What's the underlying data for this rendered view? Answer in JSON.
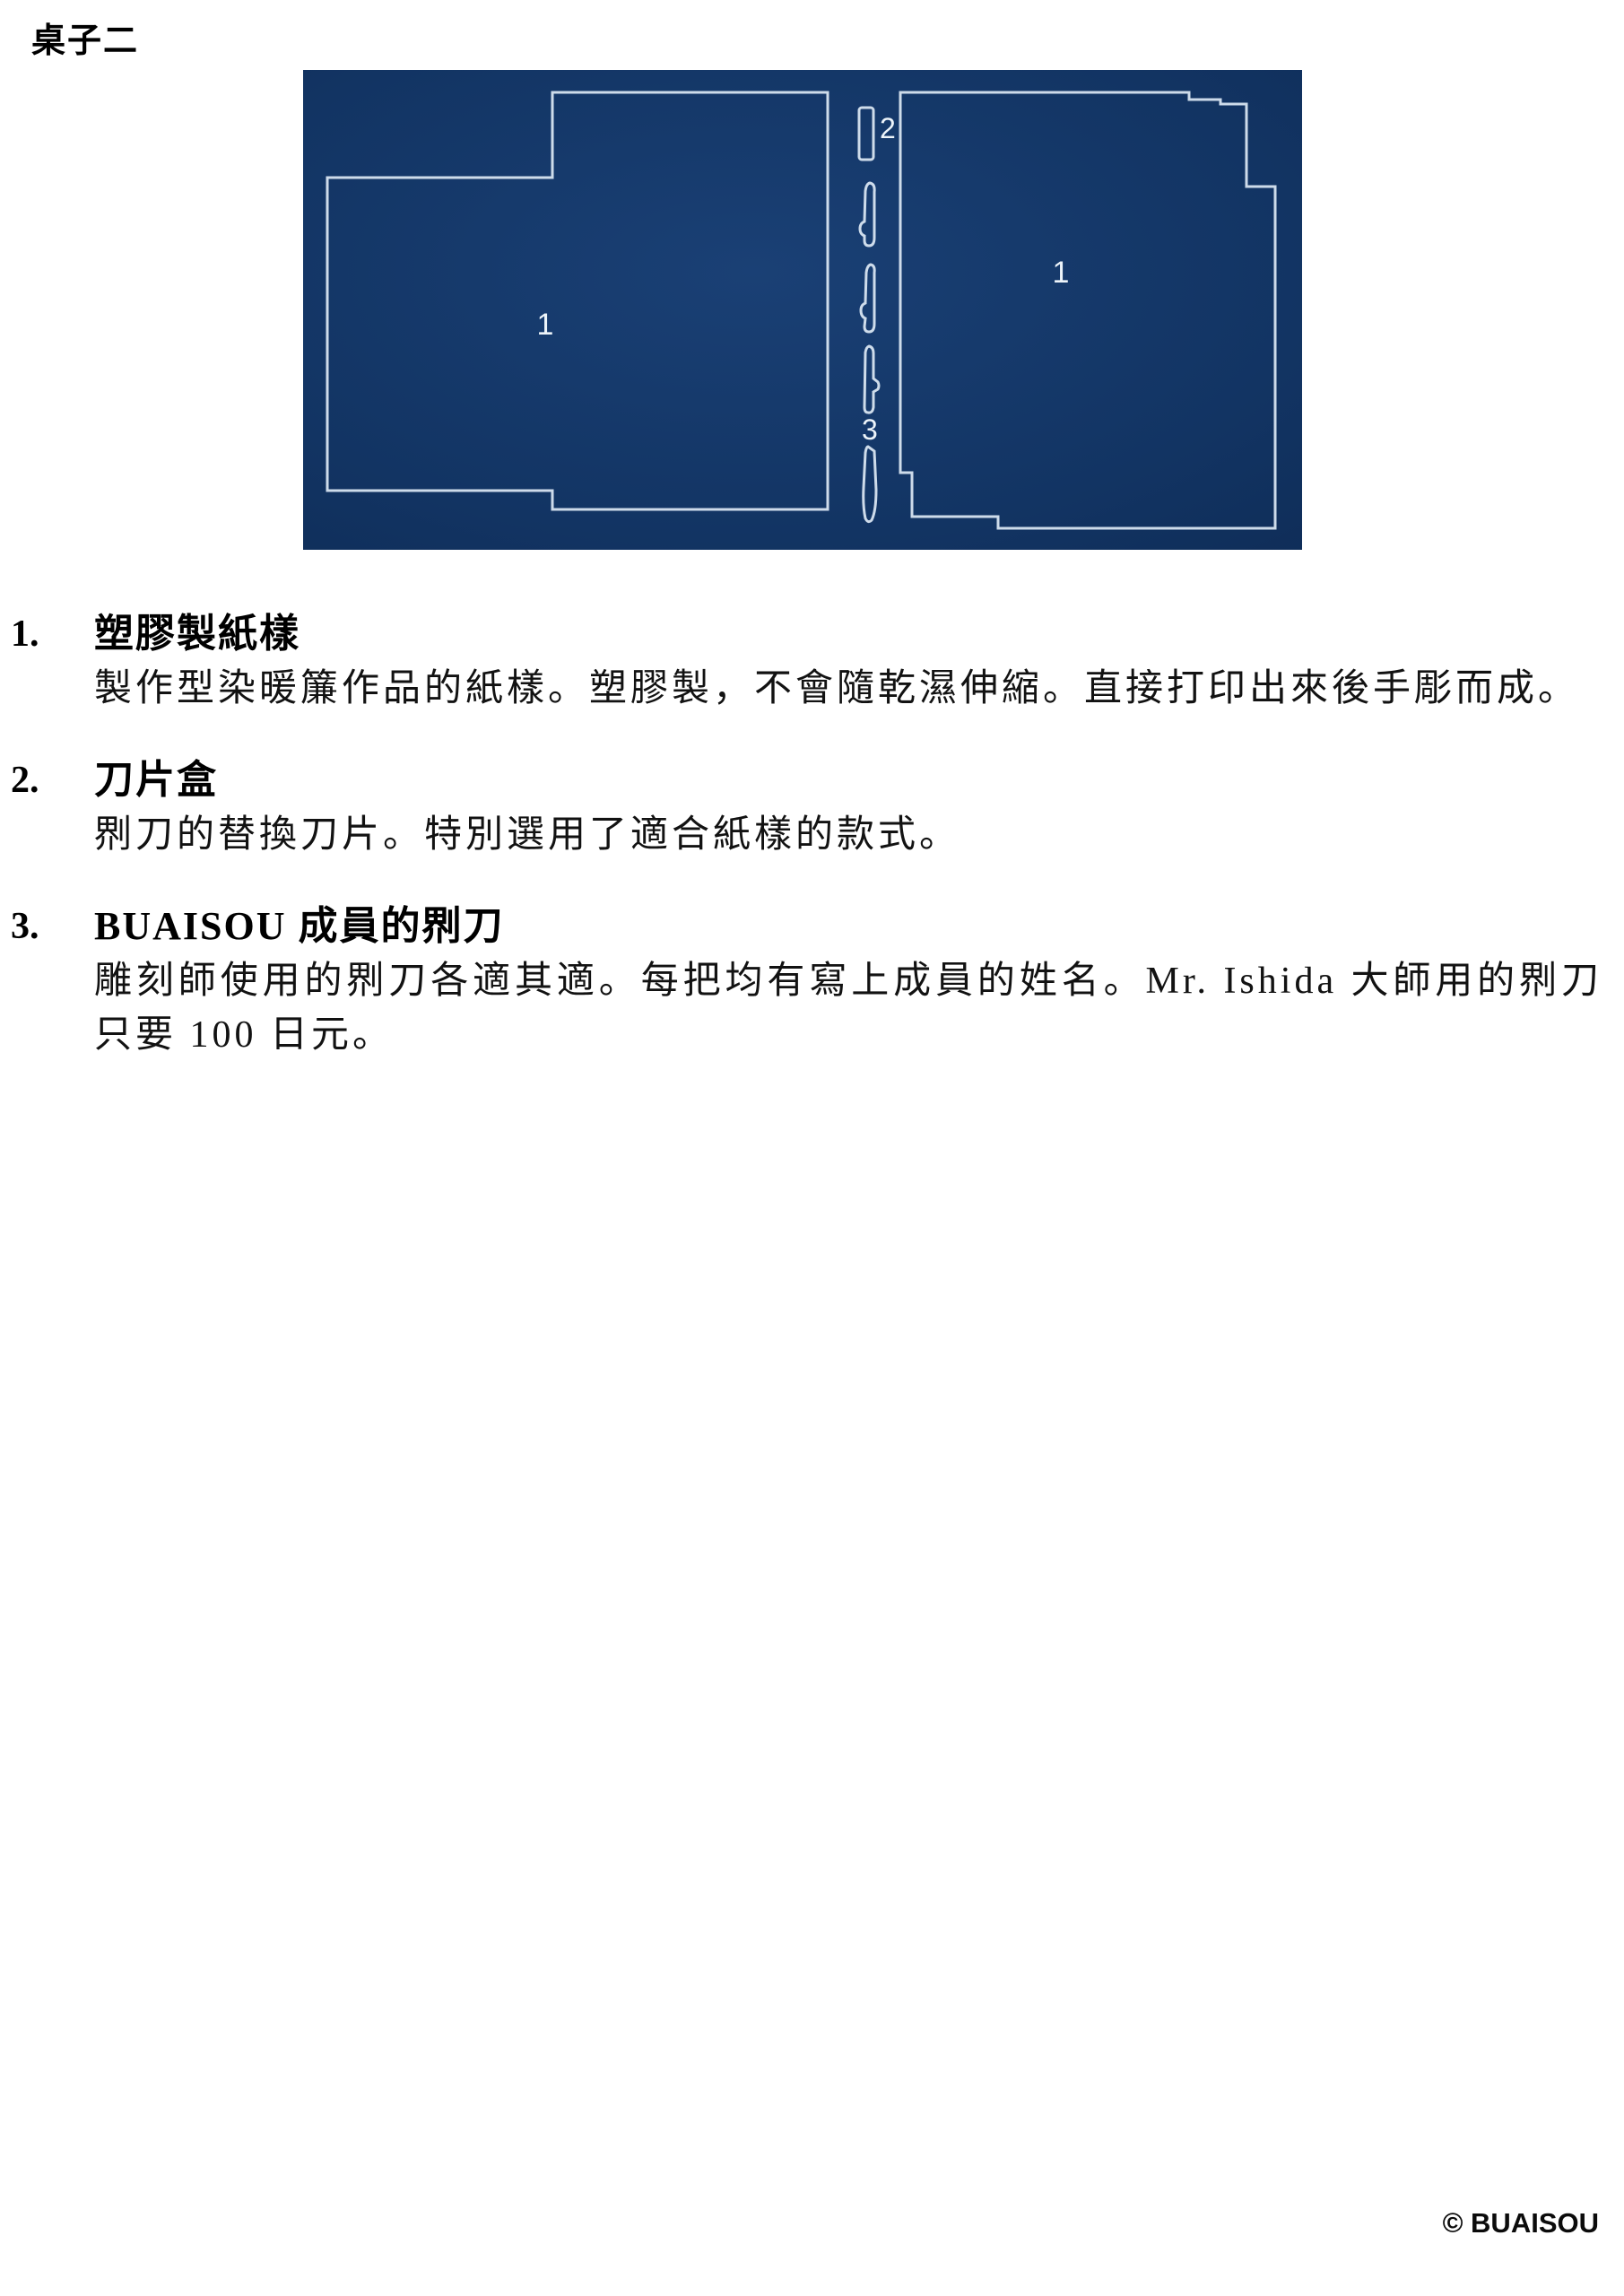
{
  "page": {
    "title": "桌子二",
    "footer": "© BUAISOU"
  },
  "figure": {
    "bg_center": "#1a4075",
    "bg_mid": "#123463",
    "bg_edge": "#0e2b55",
    "line_color": "#d8e5f1",
    "label_color": "#edf4fa",
    "labels": [
      {
        "id": "left-stencil",
        "text": "1"
      },
      {
        "id": "blade-case",
        "text": "2"
      },
      {
        "id": "member-blades",
        "text": "3"
      },
      {
        "id": "right-stencil",
        "text": "1"
      }
    ]
  },
  "items": [
    {
      "num": "1.",
      "heading": "塑膠製紙樣",
      "body": "製作型染暖簾作品的紙樣。塑膠製，不會隨乾濕伸縮。直接打印出來後手彫而成。"
    },
    {
      "num": "2.",
      "heading": "刀片盒",
      "body": "𠝹刀的替換刀片。特別選用了適合紙樣的款式。"
    },
    {
      "num": "3.",
      "heading": "BUAISOU 成員的𠝹刀",
      "body": "雕刻師使用的𠝹刀各適其適。每把均有寫上成員的姓名。Mr. Ishida 大師用的𠝹刀只要 100 日元。"
    }
  ]
}
